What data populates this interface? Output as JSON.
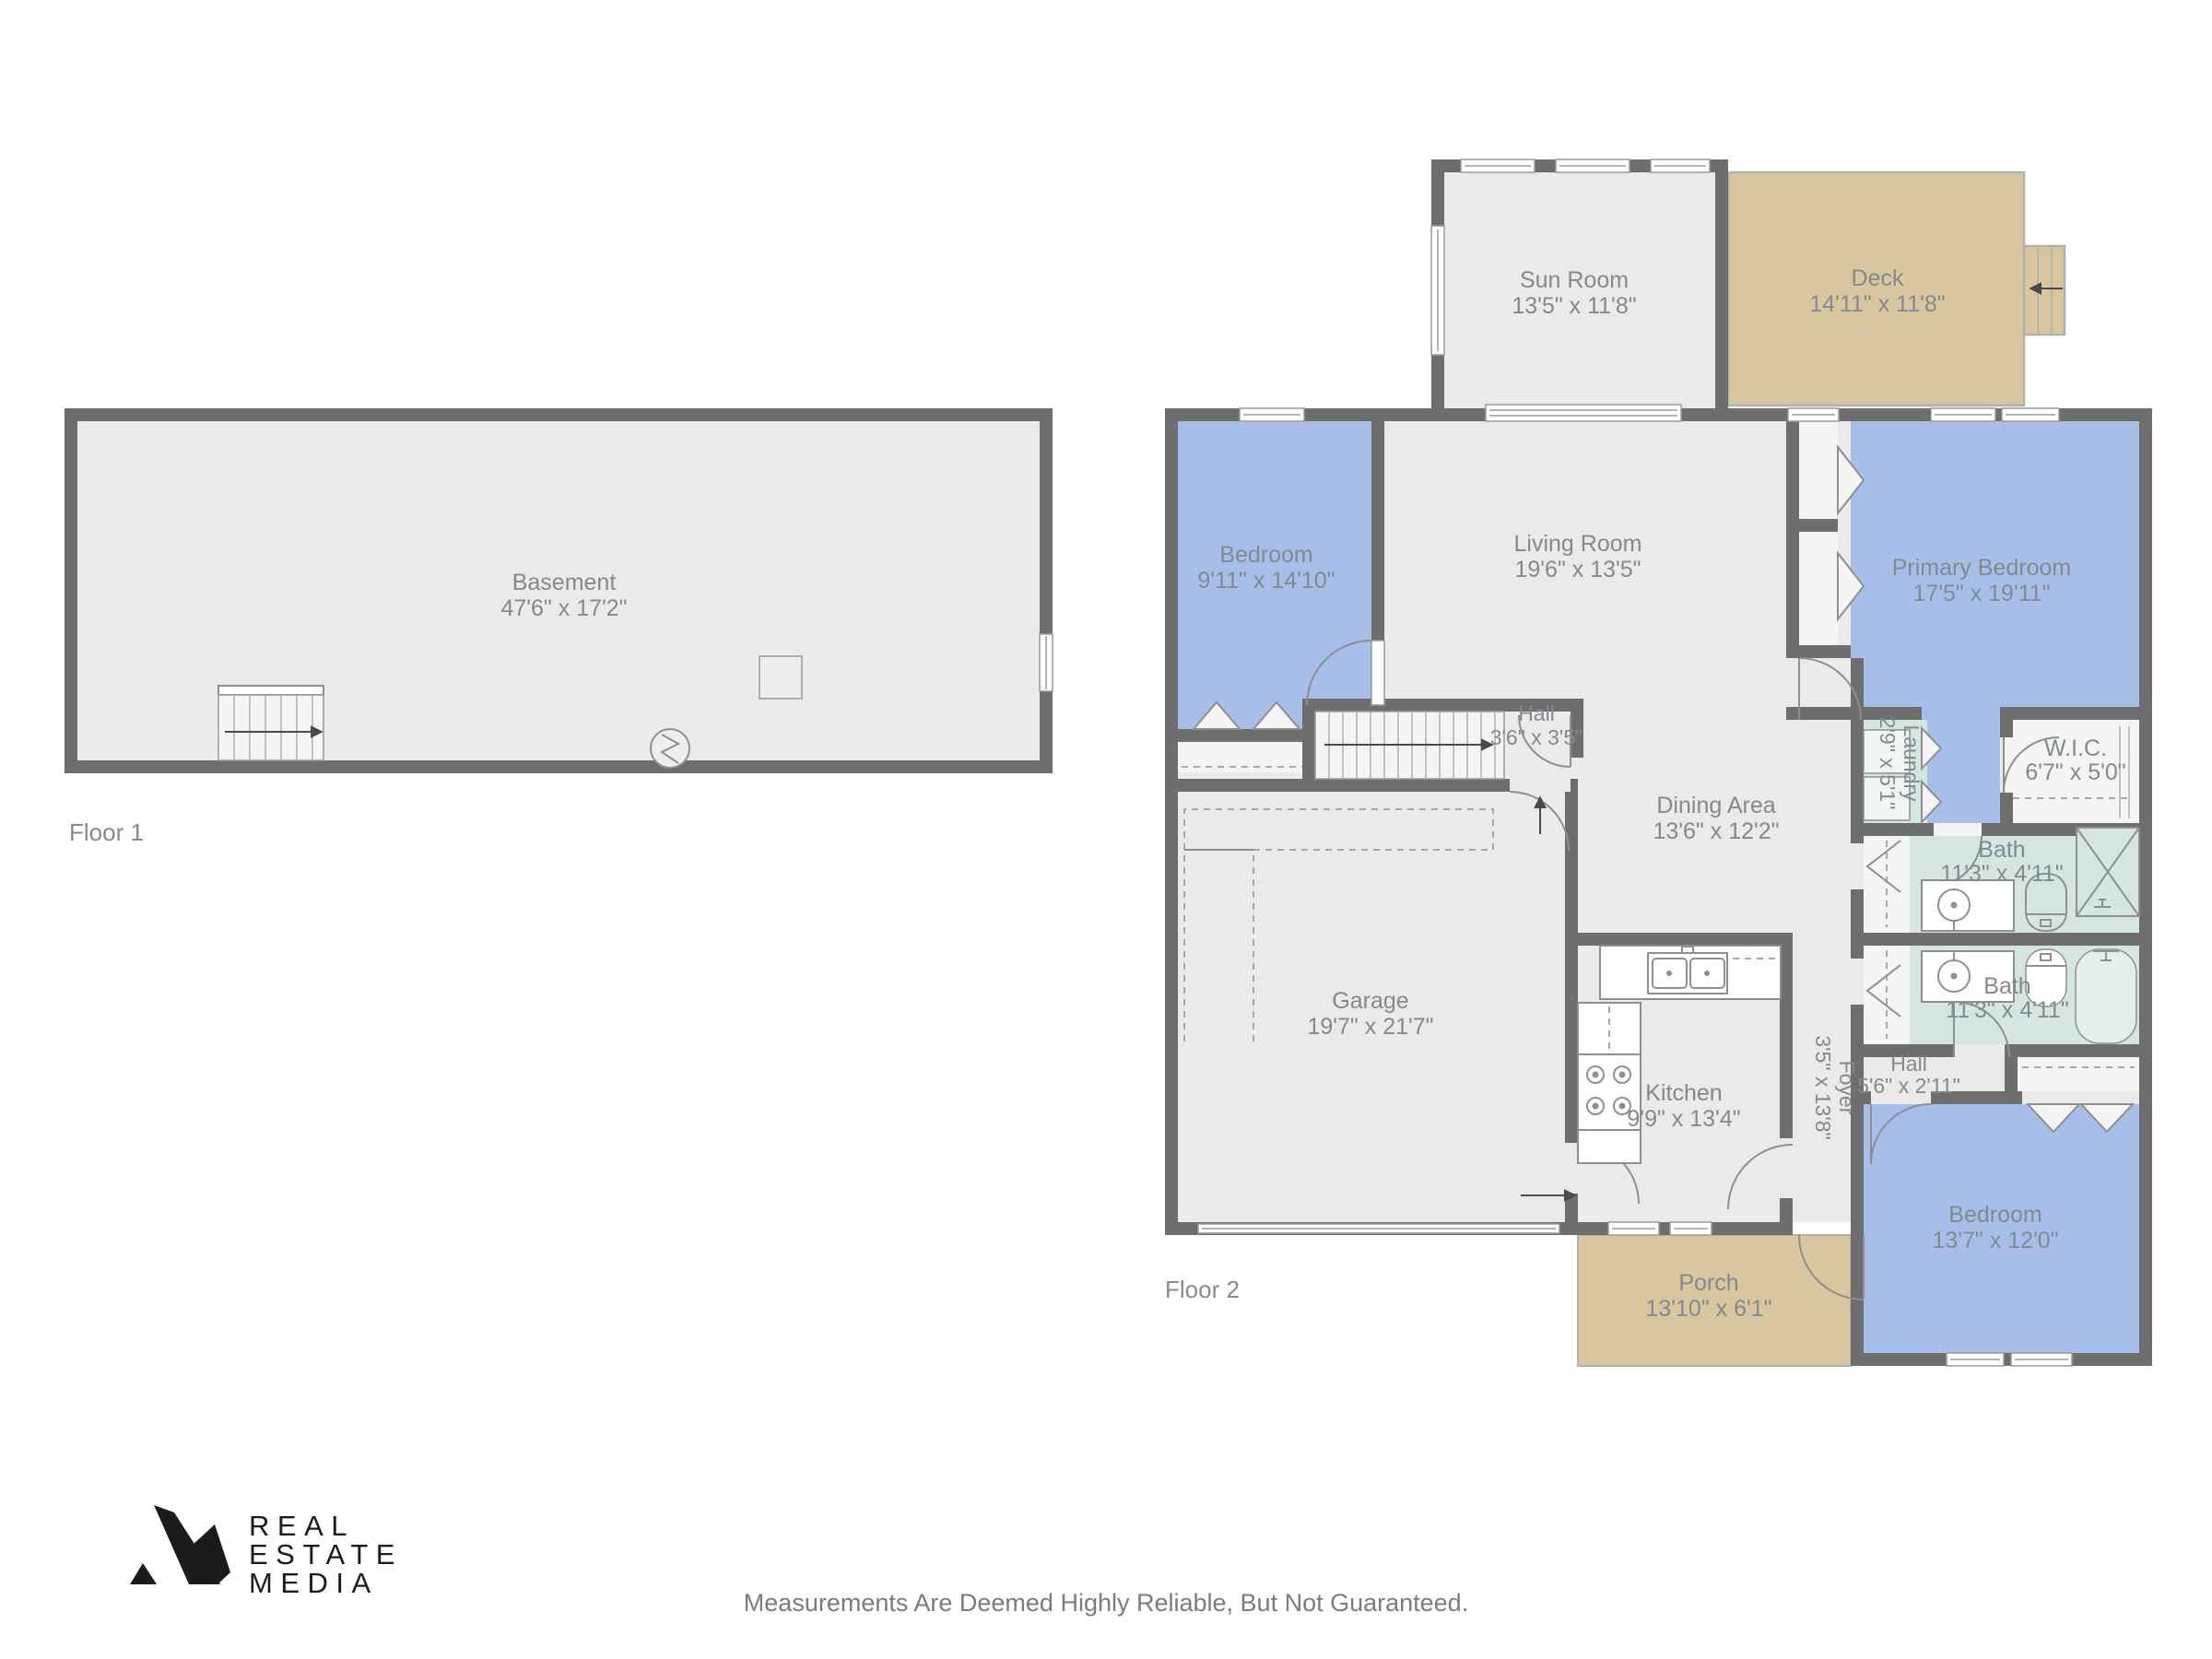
{
  "colors": {
    "wall": "#6e6e6e",
    "floor": "#ebeae8",
    "bedroom": "#a7bfe8",
    "bath": "#d5e6e1",
    "outdoor": "#d7c69e",
    "closet": "#f4f4f3",
    "window": "#ffffff",
    "label": "#828a91",
    "floor-label": "#8a8a8a",
    "disclaimer": "#7b7b7b",
    "logo": "#1b1b1b"
  },
  "floor1": {
    "label": "Floor 1",
    "rooms": {
      "basement": {
        "name": "Basement",
        "dims": "47'6\" x 17'2\""
      }
    }
  },
  "floor2": {
    "label": "Floor 2",
    "rooms": {
      "sun_room": {
        "name": "Sun Room",
        "dims": "13'5\" x 11'8\""
      },
      "deck": {
        "name": "Deck",
        "dims": "14'11\" x 11'8\""
      },
      "bedroom_upper": {
        "name": "Bedroom",
        "dims": "9'11\" x 14'10\""
      },
      "living_room": {
        "name": "Living Room",
        "dims": "19'6\" x 13'5\""
      },
      "primary_bedroom": {
        "name": "Primary Bedroom",
        "dims": "17'5\" x 19'11\""
      },
      "hall_upper": {
        "name": "Hall",
        "dims": "3'6\" x 3'5\""
      },
      "laundry": {
        "name": "Laundry",
        "dims": "2'9\" x 5'1\""
      },
      "wic": {
        "name": "W.I.C.",
        "dims": "6'7\" x 5'0\""
      },
      "bath_upper": {
        "name": "Bath",
        "dims": "11'3\" x 4'11\""
      },
      "bath_lower": {
        "name": "Bath",
        "dims": "11'3\" x 4'11\""
      },
      "dining_area": {
        "name": "Dining Area",
        "dims": "13'6\" x 12'2\""
      },
      "garage": {
        "name": "Garage",
        "dims": "19'7\" x 21'7\""
      },
      "kitchen": {
        "name": "Kitchen",
        "dims": "9'9\" x 13'4\""
      },
      "foyer": {
        "name": "Foyer",
        "dims": "3'5\" x 13'8\""
      },
      "hall_lower": {
        "name": "Hall",
        "dims": "5'6\" x 2'11\""
      },
      "porch": {
        "name": "Porch",
        "dims": "13'10\" x 6'1\""
      },
      "bedroom_lower": {
        "name": "Bedroom",
        "dims": "13'7\" x 12'0\""
      }
    }
  },
  "branding": {
    "logo_lines": [
      "REAL",
      "ESTATE",
      "MEDIA"
    ]
  },
  "disclaimer": "Measurements Are Deemed Highly Reliable, But Not Guaranteed."
}
